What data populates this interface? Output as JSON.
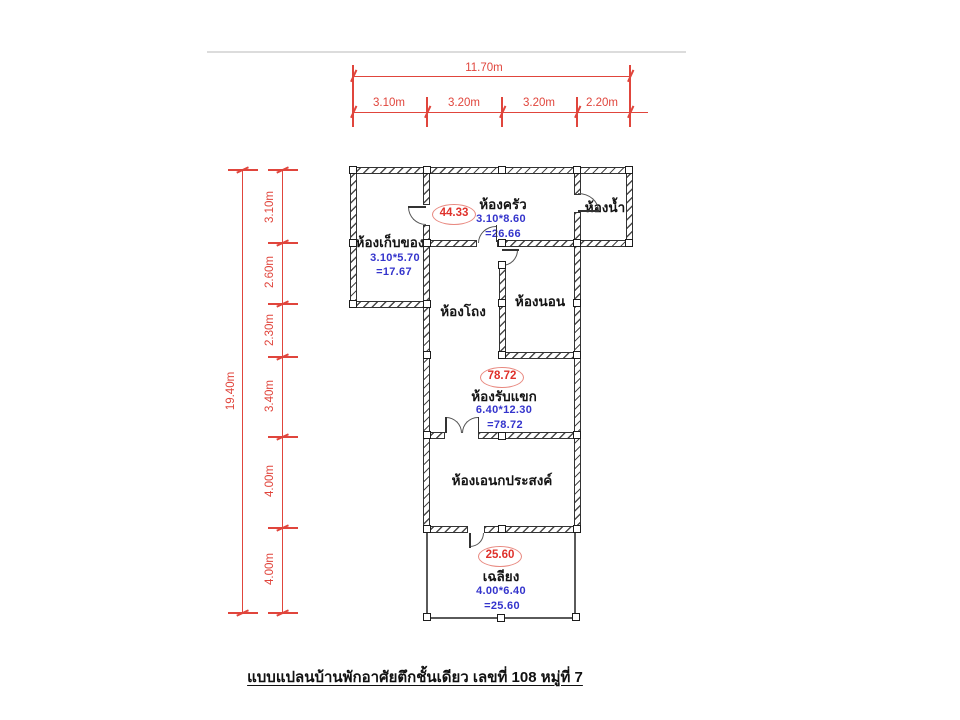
{
  "caption": "แบบแปลนบ้านพักอาศัยตึกชั้นเดียว เลขที่ 108 หมู่ที่ 7",
  "dims_top": {
    "total": "11.70m",
    "seg1": "3.10m",
    "seg2": "3.20m",
    "seg3": "3.20m",
    "seg4": "2.20m"
  },
  "dims_left": {
    "total": "19.40m",
    "seg1": "3.10m",
    "seg2": "2.60m",
    "seg3": "2.30m",
    "seg4": "3.40m",
    "seg5": "4.00m",
    "seg6": "4.00m"
  },
  "rooms": {
    "kitchen": {
      "label": "ห้องครัว",
      "size": "3.10*8.60",
      "area": "=26.66"
    },
    "bathroom": {
      "label": "ห้องน้ำ"
    },
    "storage": {
      "label": "ห้องเก็บของ",
      "size": "3.10*5.70",
      "area": "=17.67"
    },
    "hall": {
      "label": "ห้องโถง"
    },
    "bedroom": {
      "label": "ห้องนอน"
    },
    "living": {
      "label": "ห้องรับแขก",
      "size": "6.40*12.30",
      "area": "=78.72"
    },
    "multipurpose": {
      "label": "ห้องเอนกประสงค์"
    },
    "porch": {
      "label": "เฉลียง",
      "size": "4.00*6.40",
      "area": "=25.60"
    }
  },
  "badges": {
    "upper": "44.33",
    "middle": "78.72",
    "lower": "25.60"
  },
  "colors": {
    "dimension_red": "#e0453c",
    "room_size_blue": "#3434cc",
    "badge_red": "#df312b",
    "wall_dark": "#333333",
    "top_rule_gray": "#dcdcdc"
  }
}
